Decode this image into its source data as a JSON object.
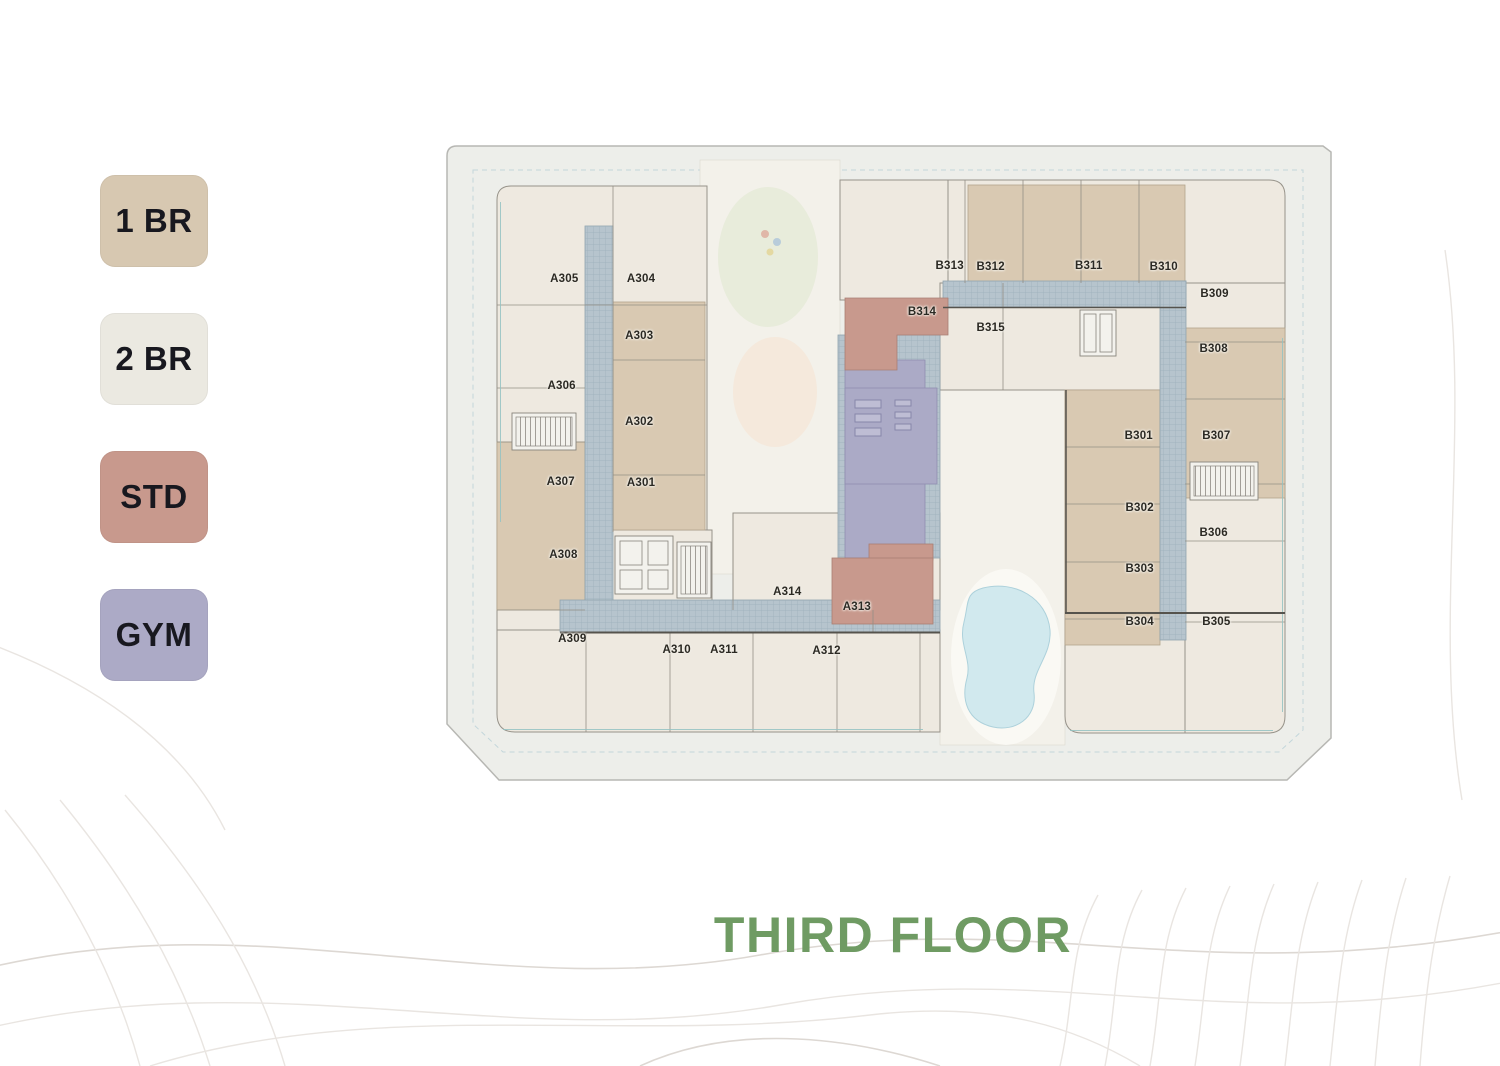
{
  "legend": {
    "items": [
      {
        "code": "1 BR",
        "color": "#d7c8b1"
      },
      {
        "code": "2 BR",
        "color": "#ebe9e1"
      },
      {
        "code": "STD",
        "color": "#c8998d"
      },
      {
        "code": "GYM",
        "color": "#acaac6"
      }
    ]
  },
  "floor_plan": {
    "title": "THIRD FLOOR",
    "title_color": "#6f9b63",
    "unit_type_colors": {
      "1BR": "#d9c9b2",
      "2BR": "#eee9e0",
      "STD": "#c8998d",
      "GYM": "#abaac6"
    },
    "units": [
      {
        "id": "A305",
        "type": "2BR",
        "x": 13.6,
        "y": 21.4
      },
      {
        "id": "A304",
        "type": "2BR",
        "x": 22.2,
        "y": 21.4
      },
      {
        "id": "A303",
        "type": "1BR",
        "x": 22.0,
        "y": 30.3
      },
      {
        "id": "A306",
        "type": "2BR",
        "x": 13.3,
        "y": 38.1
      },
      {
        "id": "A302",
        "type": "1BR",
        "x": 22.0,
        "y": 43.7
      },
      {
        "id": "A307",
        "type": "1BR",
        "x": 13.2,
        "y": 53.0
      },
      {
        "id": "A301",
        "type": "1BR",
        "x": 22.2,
        "y": 53.2
      },
      {
        "id": "A308",
        "type": "1BR",
        "x": 13.5,
        "y": 64.4
      },
      {
        "id": "A309",
        "type": "2BR",
        "x": 14.5,
        "y": 77.5
      },
      {
        "id": "A310",
        "type": "2BR",
        "x": 26.2,
        "y": 79.3
      },
      {
        "id": "A311",
        "type": "2BR",
        "x": 31.5,
        "y": 79.3
      },
      {
        "id": "A312",
        "type": "2BR",
        "x": 43.0,
        "y": 79.4
      },
      {
        "id": "A313",
        "type": "STD",
        "x": 46.4,
        "y": 72.5
      },
      {
        "id": "A314",
        "type": "2BR",
        "x": 38.6,
        "y": 70.2
      },
      {
        "id": "B313",
        "type": "2BR",
        "x": 56.8,
        "y": 19.3
      },
      {
        "id": "B312",
        "type": "1BR",
        "x": 61.4,
        "y": 19.5
      },
      {
        "id": "B311",
        "type": "1BR",
        "x": 72.4,
        "y": 19.3
      },
      {
        "id": "B310",
        "type": "1BR",
        "x": 80.8,
        "y": 19.5
      },
      {
        "id": "B309",
        "type": "2BR",
        "x": 86.5,
        "y": 23.7
      },
      {
        "id": "B314",
        "type": "STD",
        "x": 53.7,
        "y": 26.5
      },
      {
        "id": "B315",
        "type": "2BR",
        "x": 61.4,
        "y": 29.0
      },
      {
        "id": "B308",
        "type": "1BR",
        "x": 86.4,
        "y": 32.3
      },
      {
        "id": "B301",
        "type": "1BR",
        "x": 78.0,
        "y": 45.9
      },
      {
        "id": "B307",
        "type": "1BR",
        "x": 86.7,
        "y": 45.9
      },
      {
        "id": "B302",
        "type": "1BR",
        "x": 78.1,
        "y": 57.1
      },
      {
        "id": "B306",
        "type": "2BR",
        "x": 86.4,
        "y": 61.0
      },
      {
        "id": "B303",
        "type": "1BR",
        "x": 78.1,
        "y": 66.6
      },
      {
        "id": "B304",
        "type": "1BR",
        "x": 78.1,
        "y": 74.9
      },
      {
        "id": "B305",
        "type": "2BR",
        "x": 86.7,
        "y": 74.9
      }
    ]
  }
}
